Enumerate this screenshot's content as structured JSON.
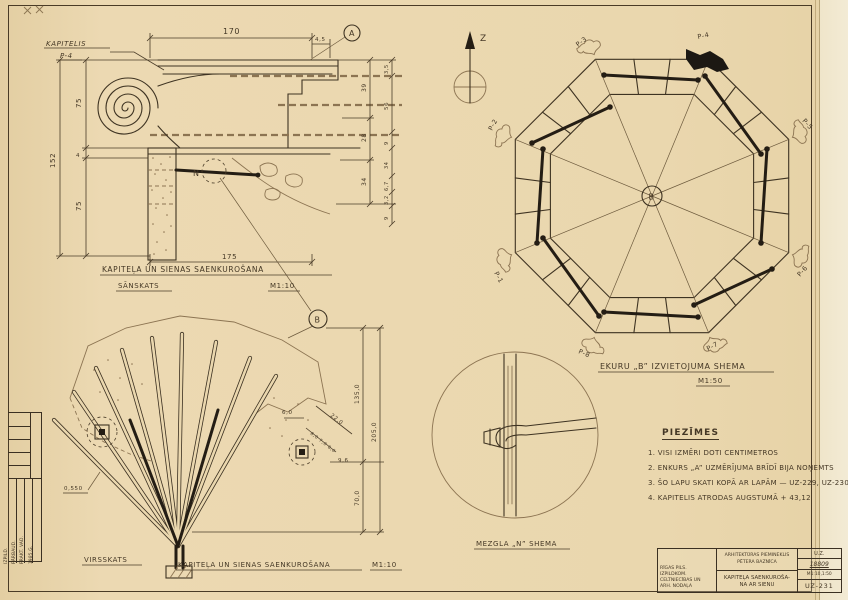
{
  "side_view": {
    "callout": "KAPITELIS",
    "callout_num": "P-4",
    "marker_a": "A",
    "marker_n": "N",
    "marker_b": "B",
    "dim_top": "170",
    "dim_top_small": "4,5",
    "dim_bottom": "175",
    "dims_left": [
      "152",
      "75",
      "4",
      "75"
    ],
    "dims_inner": [
      "39",
      "28",
      "34"
    ],
    "dims_outer": [
      "3,5",
      "56",
      "9",
      "34",
      "6,7",
      "3,2",
      "9"
    ],
    "title": "KAPITEĻA UN SIENAS SAENKUROŠANA",
    "subtitle": "SĀNSKATS",
    "scale": "M1:10"
  },
  "plan_view": {
    "label": "VIRSSKATS",
    "title": "KAPITEĻA UN SIENAS SAENKUROŠANA",
    "scale": "M1:10",
    "dim_60": "6,0",
    "dim_220": "22,0",
    "dim_row": "8,0 7,0 8,0",
    "dim_96": "9,6",
    "dim_1350": "135,0",
    "dim_2050": "205,0",
    "dim_700": "70,0",
    "dim_0550": "0,550"
  },
  "octagon": {
    "title": "EKURU „B” IZVIETOJUMA SHEMA",
    "scale": "M1:50",
    "center": "B",
    "north": "Z",
    "labels": {
      "p1": "P-1",
      "p2": "P-2",
      "p3": "P-3",
      "p4": "P-4",
      "p5": "P-5",
      "p6": "P-6",
      "p7": "P-7",
      "p8": "P-8"
    }
  },
  "node_detail": {
    "title": "MEZGLA „N” SHEMA"
  },
  "notes": {
    "heading": "PIEZĪMES",
    "items": [
      "1. VISI IZMĒRI DOTI CENTIMETROS",
      "2. ENKURS „A” UZMĒRĪJUMA BRĪDĪ BIJA NOŅEMTS",
      "3. ŠO LAPU SKATI KOPĀ AR LAPĀM — UZ-229, UZ-230",
      "4. KAPITELIS ATRODAS AUGSTUMĀ + 43,12"
    ]
  },
  "title_block": {
    "org": [
      "RĪGAS PILS. IZPILDKOM.",
      "CELTNIECĪBAS UN",
      "ARH. NODAĻA"
    ],
    "monument": [
      "ARHITEKTŪRAS PIEMINEKLIS",
      "PĒTERA BAZNĪCA"
    ],
    "subject": [
      "KAPITEĻA SAENKUROŠA-",
      "NA AR SIENU"
    ],
    "code": "U.Z.",
    "number": "18809",
    "scale": "M1:10,1:50",
    "sheet": "UZ-231"
  },
  "stamp": {
    "rows": [
      "IZPILD.",
      "PĀRBAUD.",
      "PRAKT. VAD."
    ],
    "year": "1985.G."
  }
}
